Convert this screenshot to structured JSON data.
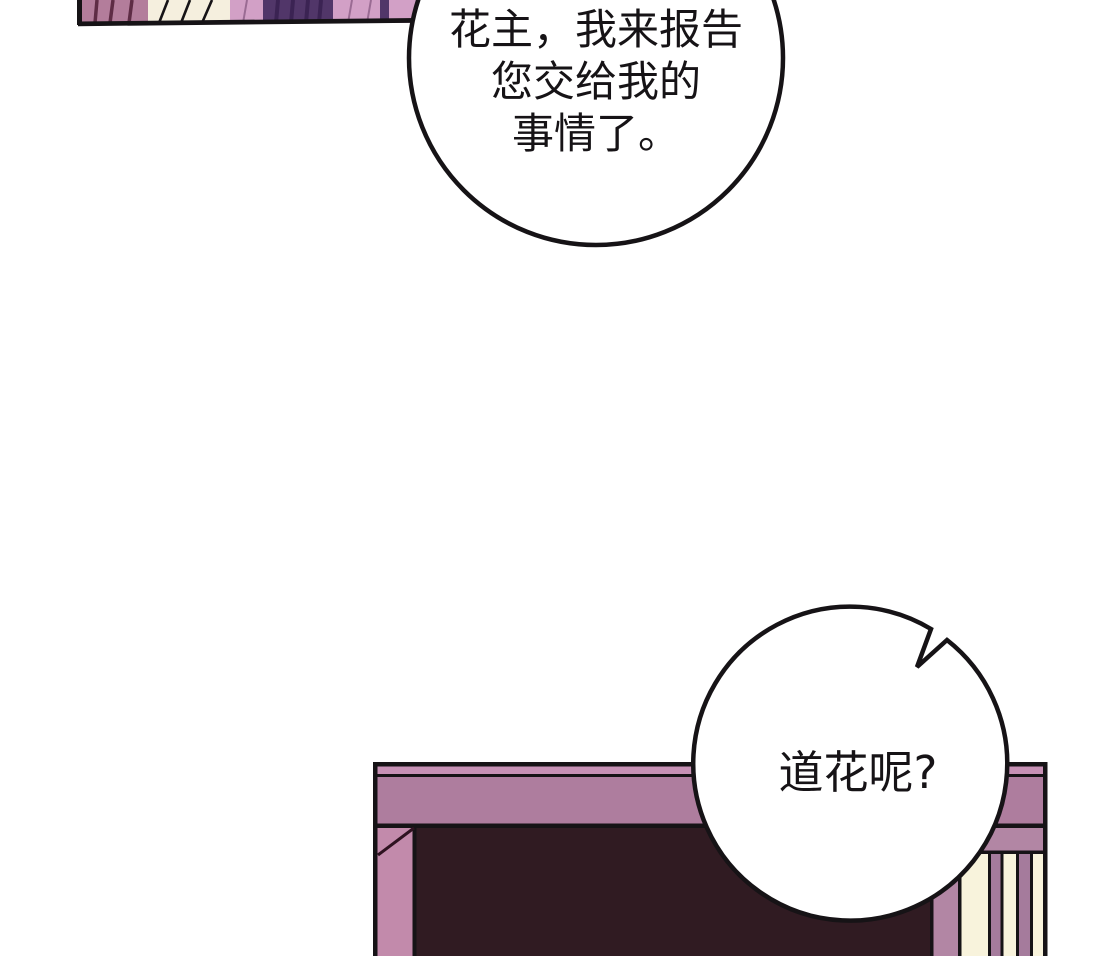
{
  "comic": {
    "panel_type": "webtoon-panel",
    "bubble_top": {
      "lines": [
        "花主，我来报告",
        "您交给我的",
        "事情了。"
      ]
    },
    "bubble_right": {
      "text": "道花呢?"
    }
  },
  "colors": {
    "background": "#ffffff",
    "outline": "#161316",
    "bubble_fill": "#ffffff",
    "text": "#161316",
    "beam_mauve": "#ae7d9e",
    "beam_highlight": "#c791b5",
    "post_pink": "#c28aab",
    "door_dark": "#301b22",
    "door_corner_line": "#2e1220",
    "band_mauve": "#b286a4",
    "screen_cream": "#f8f3dc",
    "screen_stripe": "#a57b9c",
    "fabric_rose": "#b37d9b",
    "fabric_rose_fold": "#5e2c45",
    "fabric_cream": "#f5efde",
    "fabric_pink": "#d2a0c6",
    "fabric_pink_fold": "#9a6b93",
    "fabric_purple": "#513669",
    "fabric_purple_fold": "#3b2353"
  }
}
